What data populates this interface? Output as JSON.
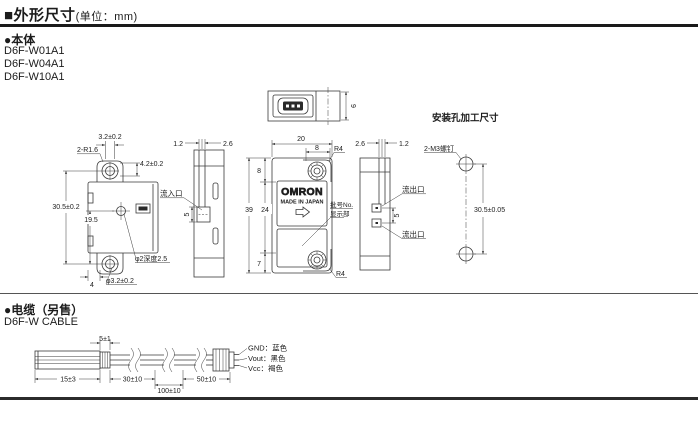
{
  "header": {
    "title": "■外形尺寸",
    "unit_note": "(单位：mm)"
  },
  "body_section": {
    "heading": "●本体",
    "models": [
      "D6F-W01A1",
      "D6F-W04A1",
      "D6F-W10A1"
    ]
  },
  "front_view": {
    "dim_ear_hole_width": "3.2±0.2",
    "dim_corner_radius": "2-R1.6",
    "dim_ear_height": "4.2±0.2",
    "dim_mount_pitch": "30.5±0.2",
    "dim_center_offset": "19.5",
    "dim_center_hole": "φ2深度2.5",
    "dim_ear_offset": "4",
    "dim_mount_hole": "φ3.2±0.2"
  },
  "left_side_view": {
    "dim_wall_left": "1.2",
    "dim_wall_right": "2.6",
    "inlet_label": "流入口",
    "dim_port": "5"
  },
  "top_view": {
    "dim_depth": "9"
  },
  "center_view": {
    "dim_width": "20",
    "dim_ear_width": "8",
    "radius_top": "R4",
    "dim_top_to_ear": "8",
    "dim_height": "39",
    "dim_body": "24",
    "dim_bottom_to_ear": "7",
    "radius_bottom": "R4",
    "brand": "OMRON",
    "origin": "MADE IN JAPAN",
    "lot_label_line1": "批号No.",
    "lot_label_line2": "显示部"
  },
  "right_side_view": {
    "dim_wall_left": "2.6",
    "dim_wall_right": "1.2",
    "outlet_label_top": "流出口",
    "outlet_label_bottom": "流出口",
    "dim_port": "5"
  },
  "mounting_view": {
    "title": "安装孔加工尺寸",
    "screw_label": "2-M3螺钉",
    "dim_pitch": "30.5±0.05"
  },
  "cable_section": {
    "heading": "●电缆（另售）",
    "model": "D6F-W CABLE",
    "dim_strip": "5±1",
    "dim_lead": "15±3",
    "dim_seg1": "30±10",
    "dim_seg2": "100±10",
    "dim_seg3": "50±10",
    "wire_gnd": "GND：蓝色",
    "wire_vout": "Vout：黑色",
    "wire_vcc": "Vcc：褐色"
  }
}
